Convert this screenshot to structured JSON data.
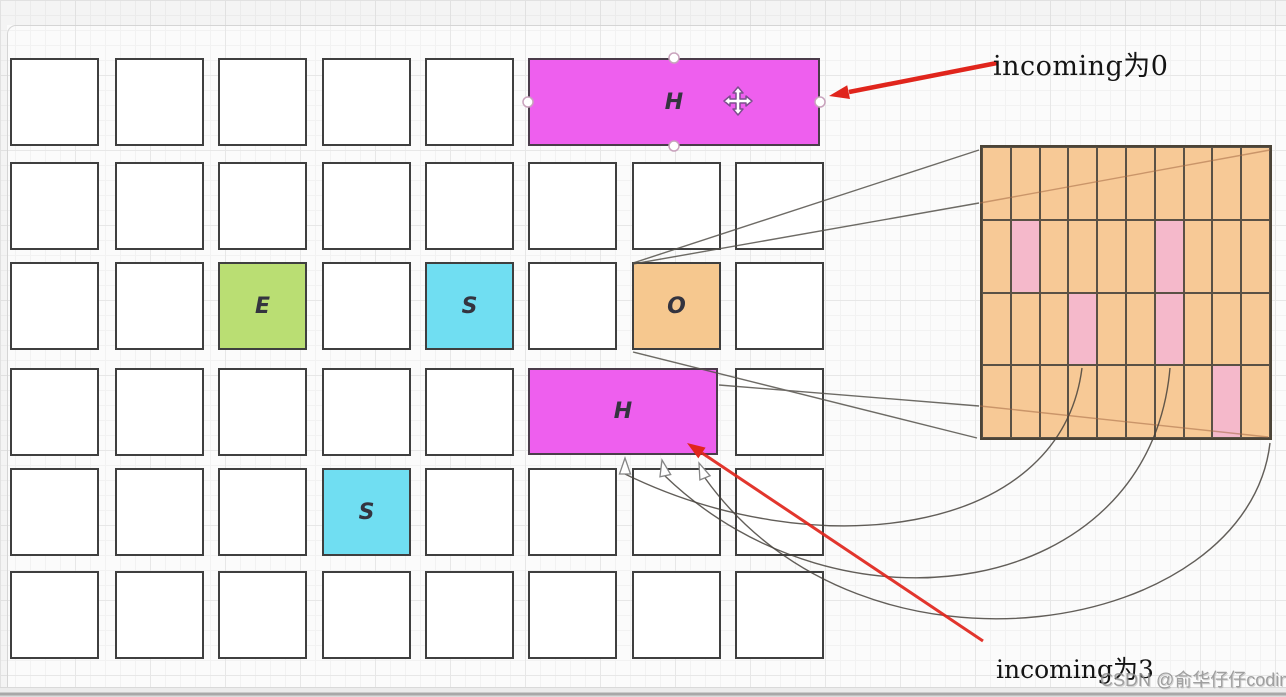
{
  "texts": {
    "incoming_top": "incoming为0",
    "incoming_bottom": "incoming为3",
    "watermark": "CSDN @俞华仔仔coding社区"
  },
  "colors": {
    "magenta": "#ee5fee",
    "green": "#bade73",
    "cyan": "#70def2",
    "orange": "#f6c88f",
    "bitmap_orange": "#f7c996",
    "bitmap_pink": "#f5b9cb",
    "cell_border": "#3f3f3f",
    "bitmap_line": "#5a5145",
    "red_arrow": "#e0251c"
  },
  "left_grid": {
    "cols": 8,
    "rows": 6,
    "col_x": [
      10,
      115,
      218,
      322,
      425,
      528,
      632,
      735
    ],
    "row_y": [
      58,
      162,
      262,
      368,
      468,
      571
    ],
    "cell_w": 89,
    "cell_h": 88,
    "covered": [
      "1-6",
      "1-7",
      "1-8",
      "4-6",
      "4-7"
    ],
    "colored_cells": [
      {
        "row": 3,
        "col": 3,
        "color": "green",
        "label": "E"
      },
      {
        "row": 3,
        "col": 5,
        "color": "cyan",
        "label": "S"
      },
      {
        "row": 3,
        "col": 7,
        "color": "orange",
        "label": "O"
      },
      {
        "row": 5,
        "col": 4,
        "color": "cyan",
        "label": "S"
      }
    ],
    "blocks": [
      {
        "id": "h-block-top",
        "x": 528,
        "y": 58,
        "w": 292,
        "h": 88,
        "label": "H",
        "color": "magenta",
        "selected": true
      },
      {
        "id": "h-block-bottom",
        "x": 528,
        "y": 368,
        "w": 190,
        "h": 87,
        "label": "H",
        "color": "magenta",
        "selected": false
      }
    ]
  },
  "bitmap_grid": {
    "x": 980,
    "y": 145,
    "w": 292,
    "h": 295,
    "cols": 10,
    "rows": 4,
    "pink_cells": [
      [
        2,
        2
      ],
      [
        2,
        7
      ],
      [
        3,
        4
      ],
      [
        3,
        7
      ],
      [
        4,
        9
      ]
    ]
  }
}
